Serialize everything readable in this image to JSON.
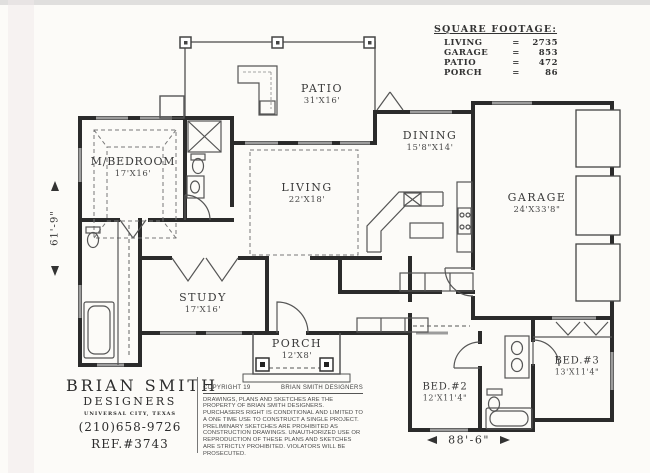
{
  "square_footage": {
    "title": "SQUARE FOOTAGE:",
    "rows": [
      {
        "label": "LIVING",
        "eq": "=",
        "value": "2735"
      },
      {
        "label": "GARAGE",
        "eq": "=",
        "value": "853"
      },
      {
        "label": "PATIO",
        "eq": "=",
        "value": "472"
      },
      {
        "label": "PORCH",
        "eq": "=",
        "value": "86"
      }
    ]
  },
  "rooms": [
    {
      "name": "PATIO",
      "size": "31'X16'"
    },
    {
      "name": "DINING",
      "size": "15'8\"X14'"
    },
    {
      "name": "M/BEDROOM",
      "size": "17'X16'"
    },
    {
      "name": "LIVING",
      "size": "22'X18'"
    },
    {
      "name": "GARAGE",
      "size": "24'X33'8\""
    },
    {
      "name": "STUDY",
      "size": "17'X16'"
    },
    {
      "name": "PORCH",
      "size": "12'X8'"
    },
    {
      "name": "BED.#2",
      "size": "12'X11'4\""
    },
    {
      "name": "BED.#3",
      "size": "13'X11'4\""
    }
  ],
  "dimensions": {
    "overall_depth": "61'-9\"",
    "overall_width": "88'-6\""
  },
  "title_block": {
    "firm_line1": "BRIAN SMITH",
    "firm_line2": "DESIGNERS",
    "location": "UNIVERSAL CITY, TEXAS",
    "phone": "(210)658-9726",
    "ref": "REF.#3743"
  },
  "copyright": {
    "header_left": "COPYRIGHT 19",
    "header_right": "BRIAN SMITH DESIGNERS",
    "body": "DRAWINGS, PLANS AND SKETCHES ARE THE PROPERTY OF BRIAN SMITH DESIGNERS.  PURCHASERS RIGHT IS CONDITIONAL AND LIMITED TO A ONE TIME USE TO CONSTRUCT A SINGLE PROJECT.  PRELIMINARY SKETCHES ARE PROHIBITED AS CONSTRUCTION DRAWINGS.  UNAUTHORIZED USE OR REPRODUCTION OF THESE PLANS AND SKETCHES ARE STRICTLY PROHIBITED.  VIOLATORS WILL BE PROSECUTED."
  }
}
